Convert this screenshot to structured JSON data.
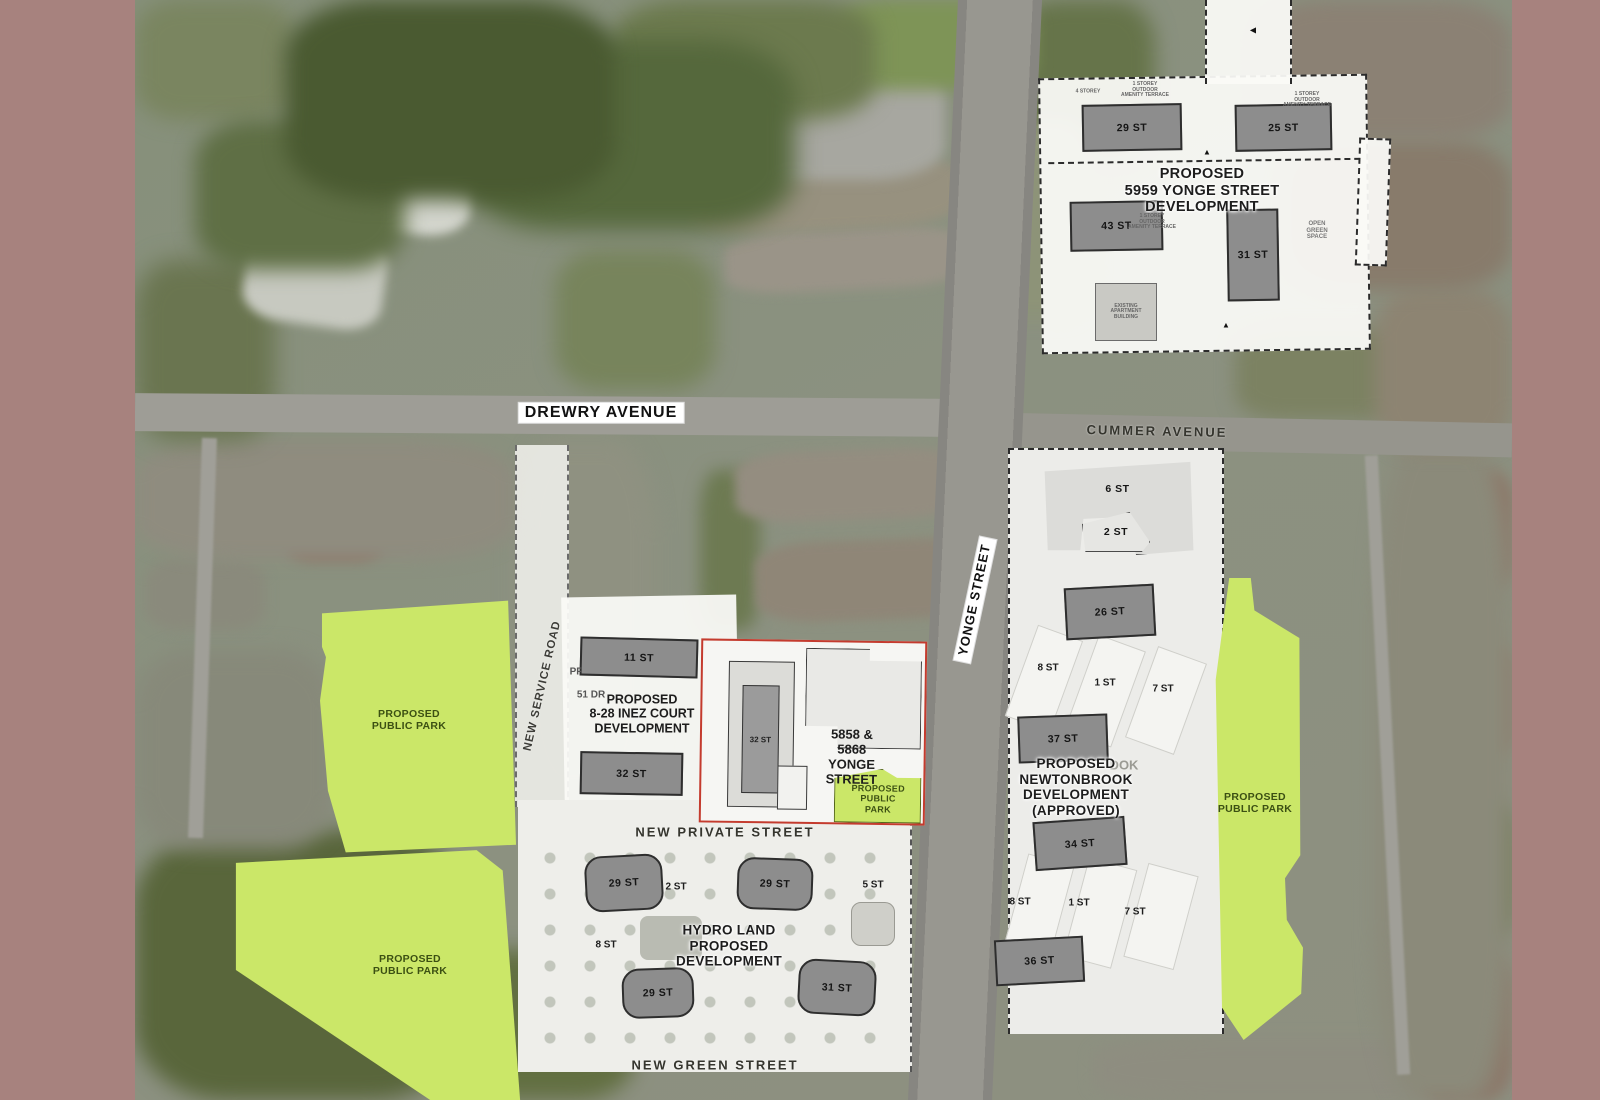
{
  "map": {
    "streets": {
      "drewry": "DREWRY AVENUE",
      "cummer": "CUMMER AVENUE",
      "yonge": "YONGE STREET",
      "new_service": "NEW SERVICE ROAD",
      "new_private": "NEW PRIVATE STREET",
      "new_green": "NEW GREEN STREET"
    },
    "parks": {
      "label": "PROPOSED\nPUBLIC PARK"
    },
    "sites": {
      "s5959": {
        "title": "PROPOSED\n5959 YONGE STREET\nDEVELOPMENT",
        "b": [
          {
            "label": "29 ST"
          },
          {
            "label": "25 ST"
          },
          {
            "label": "43 ST"
          },
          {
            "label": "31 ST"
          }
        ],
        "open_green": "OPEN\nGREEN\nSPACE",
        "terrace": "1 STOREY\nOUTDOOR\nAMENITY TERRACE",
        "storeys": "4 STOREY",
        "existing": "EXISTING\nAPARTMENT\nBUILDING"
      },
      "inez": {
        "title": "PROPOSED\n8-28 INEZ COURT\nDEVELOPMENT",
        "b": [
          {
            "label": "11 ST"
          },
          {
            "label": "32 ST"
          }
        ],
        "partials": [
          {
            "label": "PF"
          },
          {
            "label": "51 DR"
          }
        ]
      },
      "s5858": {
        "title": "5858 & 5868 YONGE\nSTREET",
        "tower": "32 ST"
      },
      "hydro": {
        "title": "HYDRO LAND\nPROPOSED\nDEVELOPMENT",
        "b": [
          {
            "label": "29 ST"
          },
          {
            "label": "29 ST"
          },
          {
            "label": "29 ST"
          },
          {
            "label": "31 ST"
          }
        ],
        "side": [
          {
            "label": "2 ST"
          },
          {
            "label": "5 ST"
          },
          {
            "label": "8 ST"
          }
        ]
      },
      "newtonbrook": {
        "title": "PROPOSED\nNEWTONBROOK\nDEVELOPMENT\n(APPROVED)",
        "ghost": "DOK",
        "b": [
          {
            "label": "6 ST"
          },
          {
            "label": "2 ST"
          },
          {
            "label": "26 ST"
          },
          {
            "label": "37 ST"
          },
          {
            "label": "34 ST"
          },
          {
            "label": "36 ST"
          }
        ],
        "row1": [
          {
            "label": "8 ST"
          },
          {
            "label": "1 ST"
          },
          {
            "label": "7 ST"
          }
        ],
        "row2": [
          {
            "label": "8 ST"
          },
          {
            "label": "1 ST"
          },
          {
            "label": "7 ST"
          }
        ]
      }
    }
  }
}
